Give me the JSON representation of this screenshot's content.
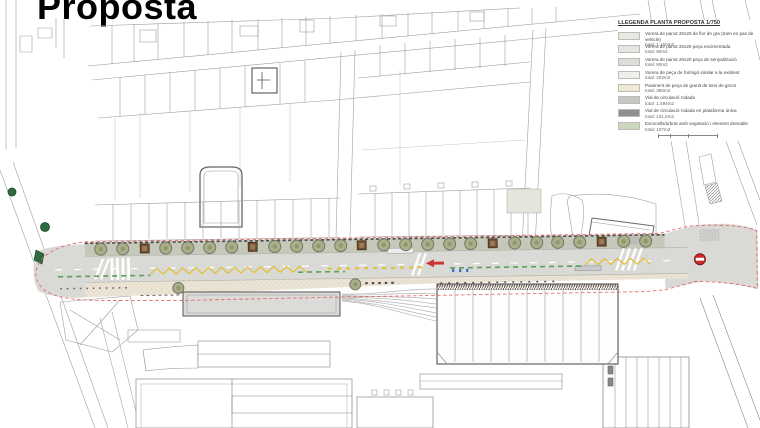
{
  "title": "Proposta",
  "legend": {
    "title": "LLEGENDA PLANTA PROPOSTA 1/750",
    "items": [
      {
        "label": "Vorera de panot 20x20 de flor de gra (tram en pas de vehicle)",
        "area": "total: 1.150m2",
        "color": "#e9e8e3"
      },
      {
        "label": "Vorera de panot 20x20 peça encimentada",
        "area": "total: 90m2",
        "color": "#e6e5e1"
      },
      {
        "label": "Vorera de panot 20x20 peça de senyalització",
        "area": "total: 90m2",
        "color": "#deddda"
      },
      {
        "label": "Vorera de peça de formigó similar a la existent",
        "area": "total: 202m2",
        "color": "#f0efec"
      },
      {
        "label": "Paviment de peça de granit de tons de grocs",
        "area": "total: 380m2",
        "color": "#f0e8d5"
      },
      {
        "label": "Vial de circulació rodada",
        "area": "total: 1.594m2",
        "color": "#c6c6c4"
      },
      {
        "label": "Vial de circulació rodada en plataforma única",
        "area": "total: 131,5m2",
        "color": "#8f8f8d"
      },
      {
        "label": "Escocells/arbrat amb vegetació i element drenable",
        "area": "total: 107m2",
        "color": "#ccd5bd"
      }
    ]
  },
  "plan": {
    "colors": {
      "road": "#d9d9d6",
      "sidewalk_upper": "#c6c8ba",
      "sidewalk_lower": "#ebe3d4",
      "tree_fill": "#a9b088",
      "tree_ring": "#73776a",
      "tree_core": "#8f9671",
      "existing_tree": "#2e6b3e",
      "planter": "#6e4f33",
      "planter_inner": "#9a7b55",
      "zigzag": "#e3bf2e",
      "bike": "#58a05a",
      "boundary": "#e05858",
      "sign_red": "#cc2b2b",
      "station_fill": "#dbdbd8",
      "plaza_fill": "#e3e6dd"
    },
    "street": {
      "trees_upper": {
        "y": 245,
        "r": 6,
        "x": [
          101,
          123,
          166,
          188,
          210,
          232,
          275,
          297,
          319,
          341,
          384,
          406,
          428,
          450,
          471,
          515,
          537,
          558,
          580,
          624,
          646
        ]
      },
      "trees_lower": [
        {
          "x": 178,
          "y": 285
        },
        {
          "x": 355,
          "y": 284
        }
      ],
      "planters": {
        "y": 240.5,
        "size": 9,
        "x": [
          145,
          253,
          362,
          493,
          602
        ]
      },
      "zigzags": [
        {
          "x1": 150,
          "x2": 312,
          "y": 268
        },
        {
          "x1": 585,
          "x2": 652,
          "y": 265
        }
      ],
      "yellow_dashes": [
        {
          "x1": 328,
          "x2": 426,
          "y": 268
        }
      ],
      "green_dashes": [
        {
          "x1": 58,
          "x2": 150,
          "y": 272
        },
        {
          "x1": 298,
          "x2": 345,
          "y": 271
        },
        {
          "x1": 450,
          "x2": 585,
          "y": 269
        }
      ],
      "blue_markers": [
        {
          "x": 452,
          "y": 270
        },
        {
          "x": 459,
          "y": 270
        },
        {
          "x": 466,
          "y": 270
        }
      ]
    }
  }
}
